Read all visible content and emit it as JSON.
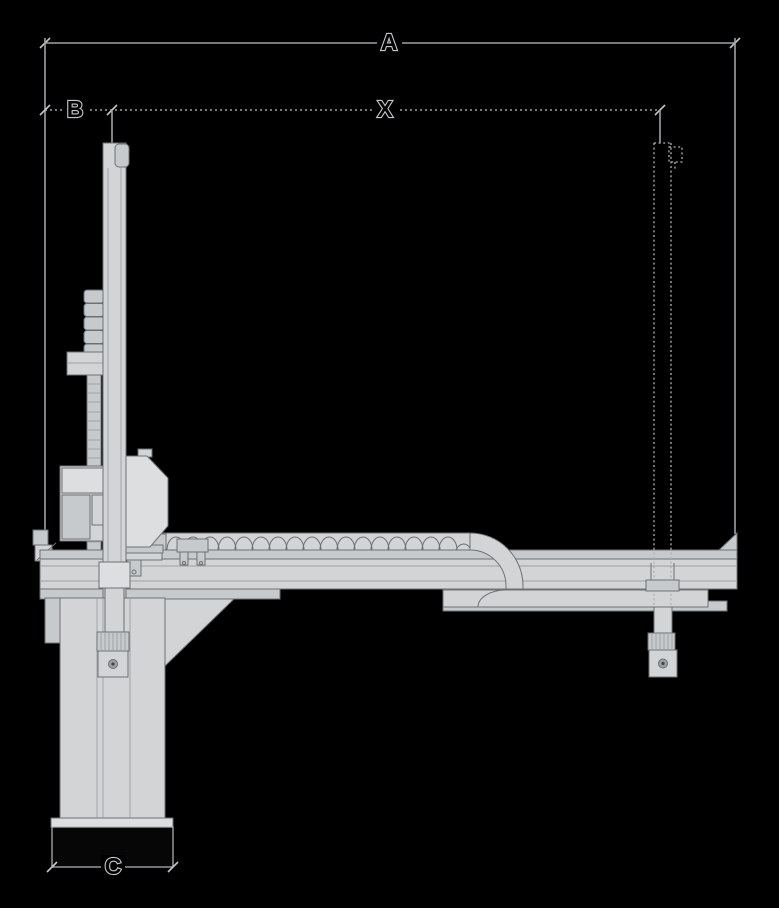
{
  "diagram": {
    "description": "technical side-view dimension drawing of a linear gantry robot",
    "labels": {
      "a": "A",
      "b": "B",
      "x": "X",
      "c": "C"
    },
    "colors": {
      "background": "#000000",
      "machine_fill": "#d2d4d6",
      "machine_stroke": "#6d7175",
      "dimension_line": "#9ea2a6",
      "label_halo": "#c4c7c9",
      "label_fill": "#000000"
    }
  }
}
